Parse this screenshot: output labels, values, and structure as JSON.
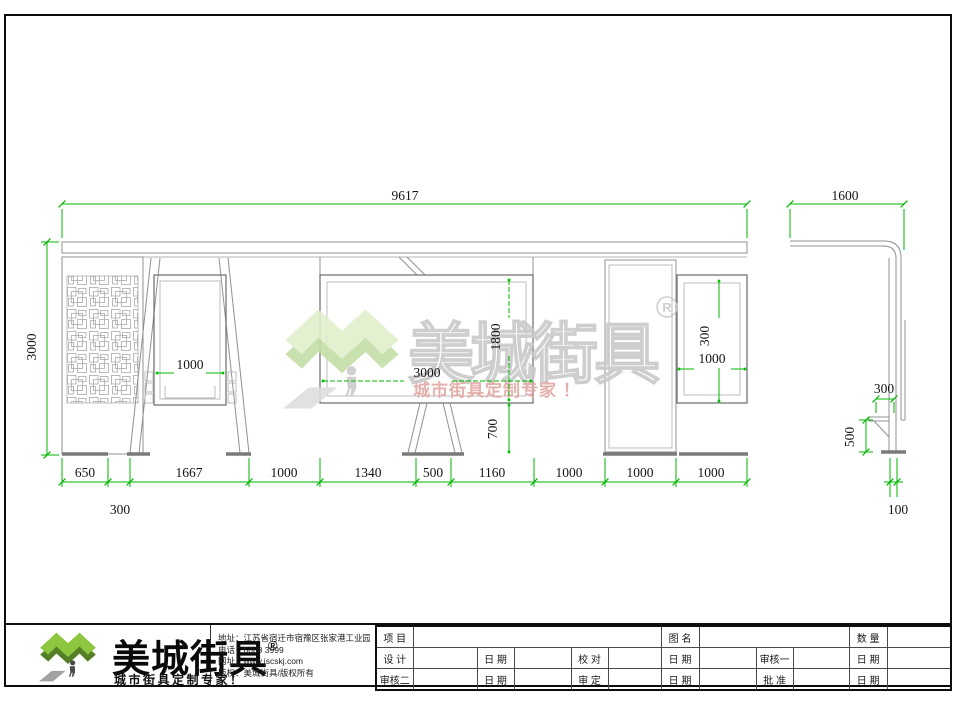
{
  "watermark": {
    "brand": "美城街具",
    "registered": "R",
    "slogan": "城市街具定制专家 ！"
  },
  "dimensions": {
    "total_width": "9617",
    "total_height": "3000",
    "bottom_row": [
      "650",
      "1667",
      "1000",
      "1340",
      "500",
      "1160",
      "1000",
      "1000",
      "1000"
    ],
    "leg_gap": "300",
    "left_panel_width": "1000",
    "screen_width": "3000",
    "screen_height": "1800",
    "screen_ground_clearance": "700",
    "right_panel_height": "300",
    "right_panel_width": "1000",
    "side_width": "1600",
    "side_seat_depth": "300",
    "side_seat_height": "500",
    "side_post_width": "100"
  },
  "footer": {
    "brand": "美城街具",
    "registered": "®",
    "slogan": "城市街具定制专家！",
    "address": "地址：江苏省宿迁市宿豫区张家港工业园区南丰路西侧1号",
    "phone": "电话：6088 3999",
    "website": "网址：www.jscskj.com",
    "copyright": "版权：美城街具/版权所有"
  },
  "title_block": {
    "r1": [
      "项 目",
      "图 名",
      "数 量"
    ],
    "r2": [
      "设 计",
      "日 期",
      "校 对",
      "日 期",
      "审核一",
      "日 期"
    ],
    "r3": [
      "审核二",
      "日 期",
      "审 定",
      "日 期",
      "批 准",
      "日 期"
    ]
  }
}
